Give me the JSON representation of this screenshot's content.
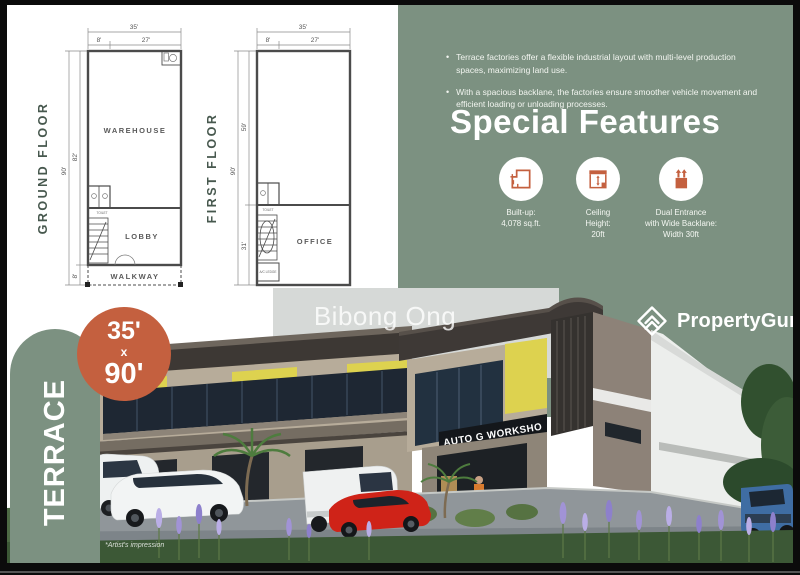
{
  "brand": {
    "name": "PropertyGuru"
  },
  "watermark": "Bibong Ong",
  "badge": {
    "label": "TERRACE",
    "size_top": "35'",
    "size_mid": "x",
    "size_bottom": "90'"
  },
  "plans": {
    "ground": {
      "title": "GROUND FLOOR",
      "width_total": "35'",
      "width_left": "8'",
      "width_right": "27'",
      "depth_total": "90'",
      "depth_main": "82'",
      "depth_walkway": "8'",
      "room_warehouse": "WAREHOUSE",
      "room_toilet": "TOILET",
      "room_lobby": "LOBBY",
      "room_walkway": "WALKWAY"
    },
    "first": {
      "title": "FIRST FLOOR",
      "width_total": "35'",
      "width_left": "8'",
      "width_right": "27'",
      "depth_total": "90'",
      "depth_upper": "59'",
      "depth_lower": "31'",
      "room_toilet": "TOILET",
      "room_office": "OFFICE",
      "room_ac": "A/C LEDGE"
    }
  },
  "info": {
    "bullets": [
      "Terrace factories offer a flexible industrial layout with multi-level production spaces, maximizing land use.",
      "With a spacious backlane, the factories ensure smoother vehicle movement and efficient loading or unloading processes."
    ],
    "heading": "Special Features",
    "features": [
      {
        "icon": "built-up-floorplan-icon",
        "lines": [
          "Built-up:",
          "4,078 sq.ft."
        ]
      },
      {
        "icon": "ceiling-height-icon",
        "lines": [
          "Ceiling",
          "Height:",
          "20ft"
        ]
      },
      {
        "icon": "dual-entrance-icon",
        "lines": [
          "Dual Entrance",
          "with Wide Backlane:",
          "Width 30ft"
        ]
      }
    ]
  },
  "render": {
    "sign": "AUTO G WORKSHO",
    "artist_note": "*Artist's impression"
  },
  "colors": {
    "panel_green": "#7c9181",
    "terracotta": "#c4603f",
    "plan_title": "#47584e",
    "accent_yellow": "#ddd24f",
    "sign_bg": "#14171b"
  }
}
